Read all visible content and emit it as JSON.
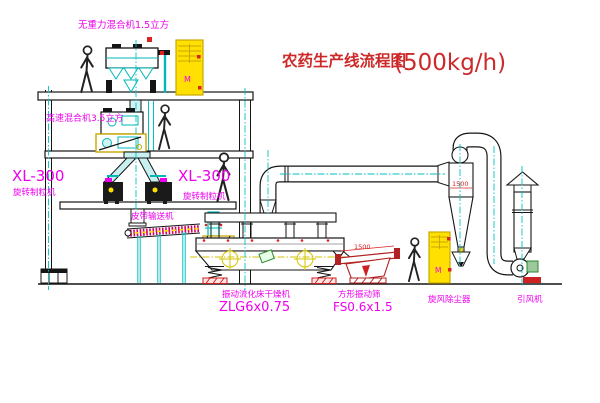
{
  "title": {
    "name": "农药生产线流程图",
    "capacity": "(500kg/h)"
  },
  "labels": {
    "gravity_mixer": "无重力混合机1.5立方",
    "high_speed_mixer": "高速混合机3.5立方",
    "granulator_model_left": "XL-300",
    "granulator_name_left": "旋转制粒机",
    "granulator_model_right": "XL-300",
    "granulator_name_right": "旋转制粒机",
    "belt_conveyor": "皮带输送机",
    "dryer_name": "振动流化床干燥机",
    "dryer_model": "ZLG6x0.75",
    "sieve_name": "方形振动筛",
    "sieve_model": "FS0.6x1.5",
    "cyclone_name": "旋风除尘器",
    "fan_name": "引风机",
    "sieve_dimension": "1500",
    "cyclone_dimension": "1500",
    "cabinet_mark_1": "M",
    "cabinet_mark_2": "M"
  },
  "colors": {
    "cad_cyan": "#00c2c2",
    "label_magenta": "#ee00ee",
    "title_red": "#cc2a2a",
    "dimension_red": "#dd2222",
    "cabinet_yellow": "#ffe000",
    "sieve_dark_red": "#b22222",
    "motor_green": "#2a8a2a",
    "line_black": "#151515"
  }
}
